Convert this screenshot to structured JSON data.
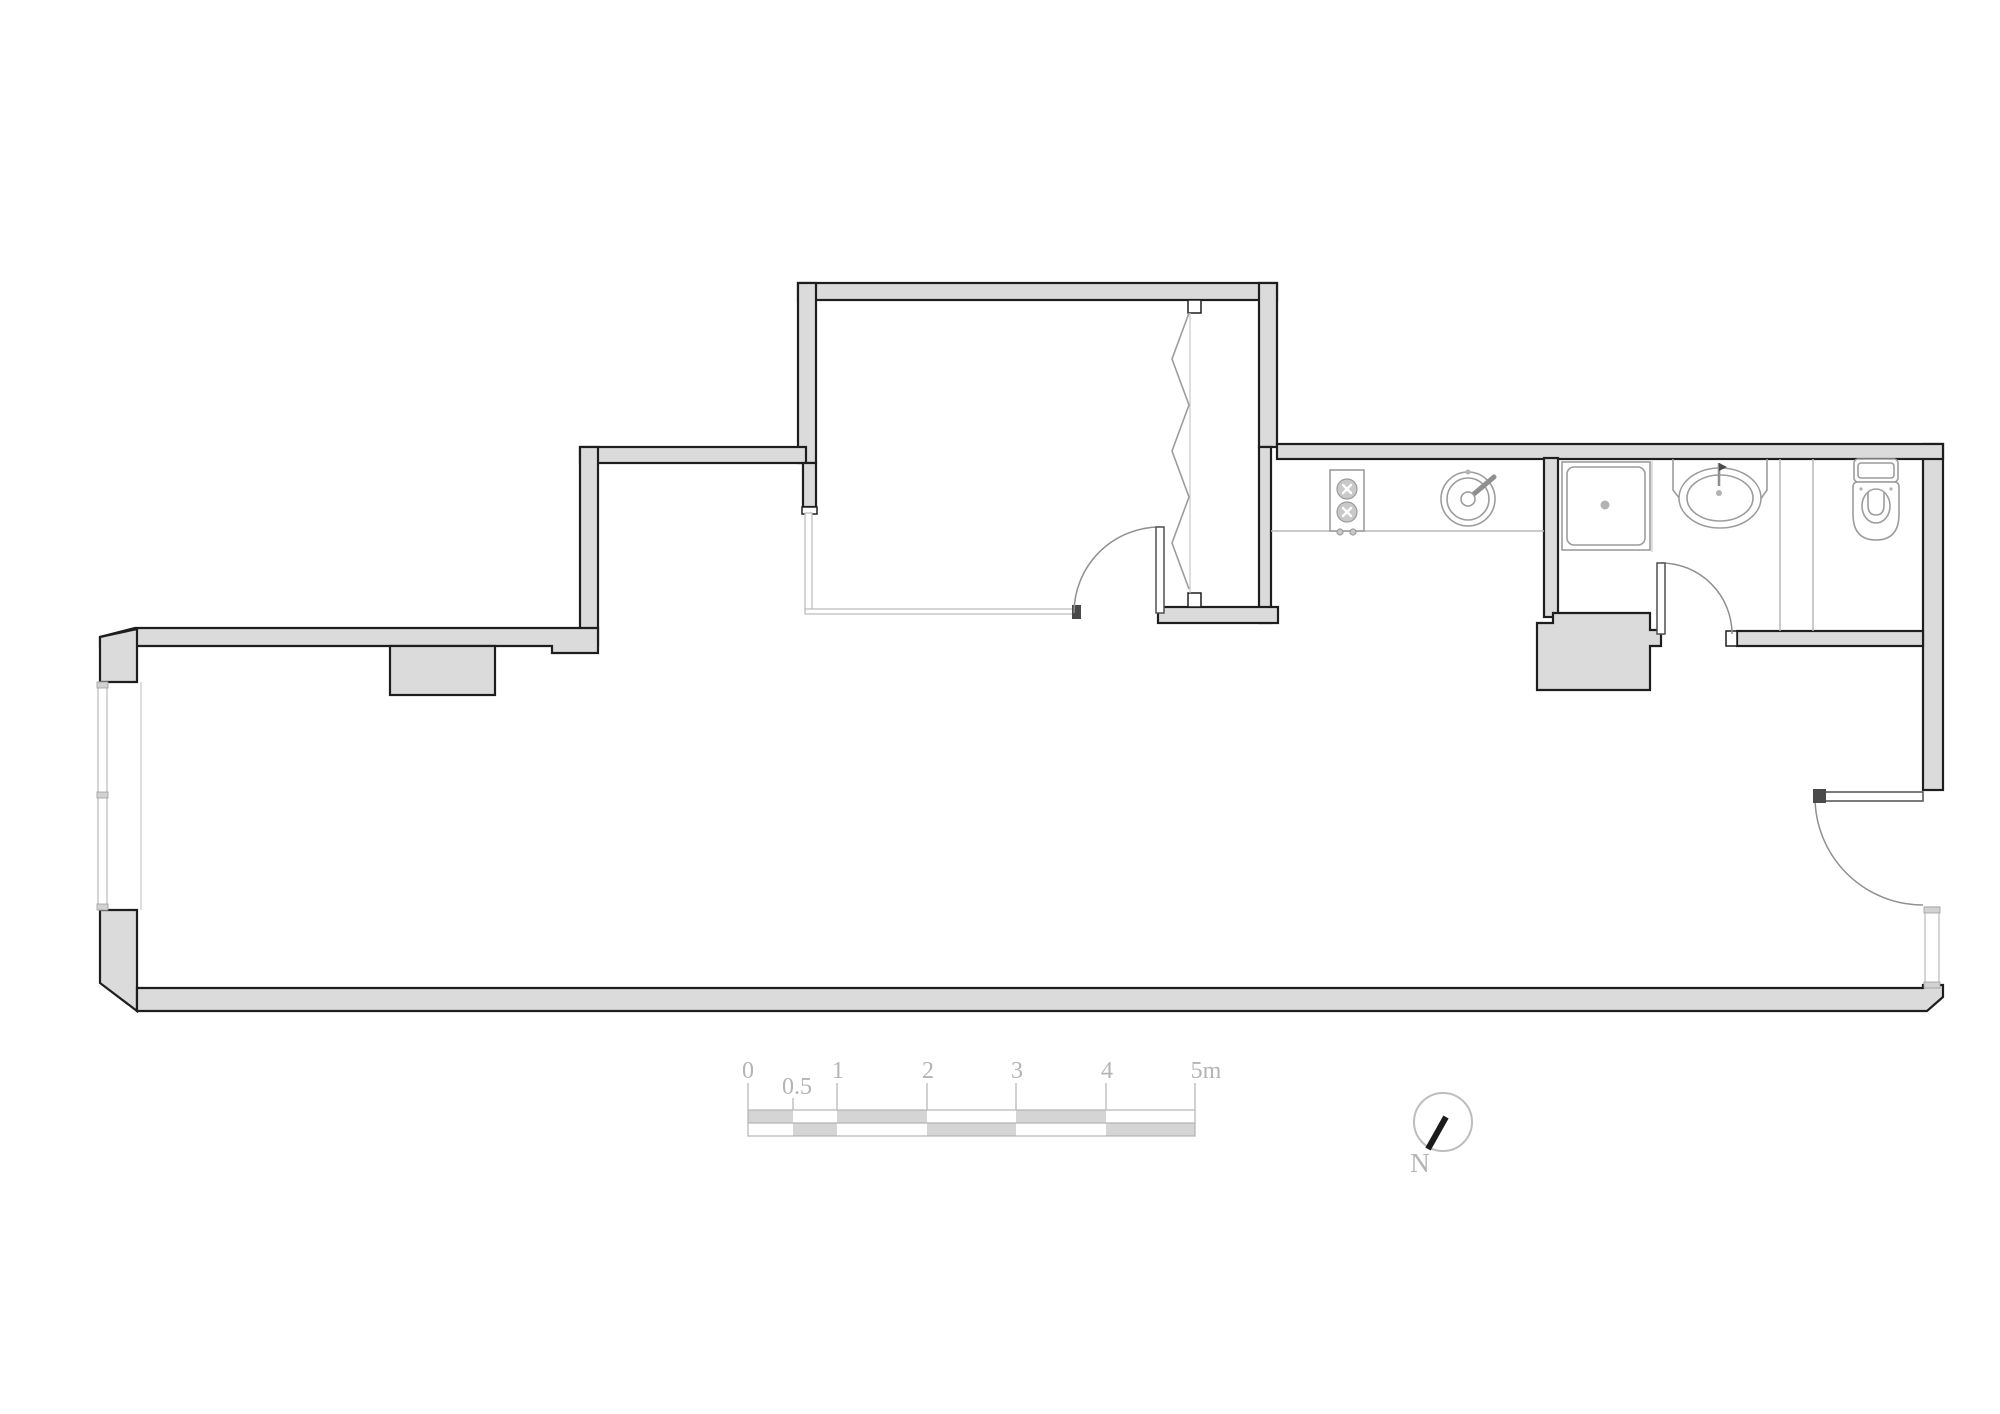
{
  "drawing": {
    "type": "apartment-floor-plan",
    "rooms": [
      "living-room",
      "bedroom",
      "kitchen-nook",
      "bathroom"
    ],
    "fixtures": [
      "cooktop-icon",
      "round-sink-icon",
      "shower-tray-icon",
      "washbasin-icon",
      "toilet-icon",
      "wardrobe-folding-door-icon",
      "window-icon",
      "swing-door-icon"
    ]
  },
  "colors": {
    "wall-fill": "#dbdbdb",
    "wall-outline": "#1e1e1e",
    "fixture-line": "#9c9c9c",
    "light-line": "#b9b9b9",
    "scale-fill": "#d5d5d5",
    "label-color": "#b4b4b4",
    "needle-color": "#1b1b1b"
  },
  "scalebar": {
    "labels": [
      "0",
      "0.5",
      "1",
      "2",
      "3",
      "4",
      "5m"
    ],
    "unit": "m"
  },
  "north": {
    "label": "N"
  }
}
